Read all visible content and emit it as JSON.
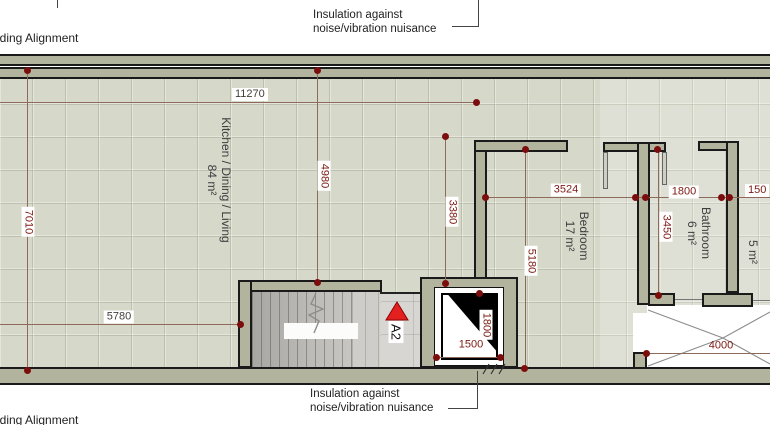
{
  "plan": {
    "alignment_label_top": "lding Alignment",
    "alignment_label_bottom": "lding Alignment",
    "insulation_note_top": {
      "line1": "Insulation against",
      "line2": "noise/vibration nuisance"
    },
    "insulation_note_bottom": {
      "line1": "Insulation against",
      "line2": "noise/vibration nuisance"
    },
    "section_marker": "A2",
    "rooms": [
      {
        "name": "Kitchen / Dining / Living",
        "area": "84 m²"
      },
      {
        "name": "Bedroom",
        "area": "17 m²"
      },
      {
        "name": "Bathroom",
        "area": "6 m²"
      },
      {
        "name": "",
        "area": "5 m²"
      }
    ],
    "dimensions": {
      "overall_width": "11270",
      "left_depth": "7010",
      "kitchen_depth": "4980",
      "stair_zone_width": "5780",
      "bedroom_offset_depth": "3380",
      "bedroom_width": "3524",
      "bedroom_depth": "5180",
      "bathroom_width": "1800",
      "bathroom_depth": "3450",
      "right_clipped": "150",
      "elevator_width": "1500",
      "elevator_depth": "1800",
      "terrace_width": "4000"
    },
    "colors": {
      "wall_fill": "#b2b49e",
      "wall_outline": "#1a1a1a",
      "floor_tile": "#d6d8ca",
      "dimension_red": "#7c1a12",
      "dimension_dark": "#433f3a",
      "dimension_point": "#7b0d0d",
      "marker_red": "#e41f1f"
    }
  }
}
